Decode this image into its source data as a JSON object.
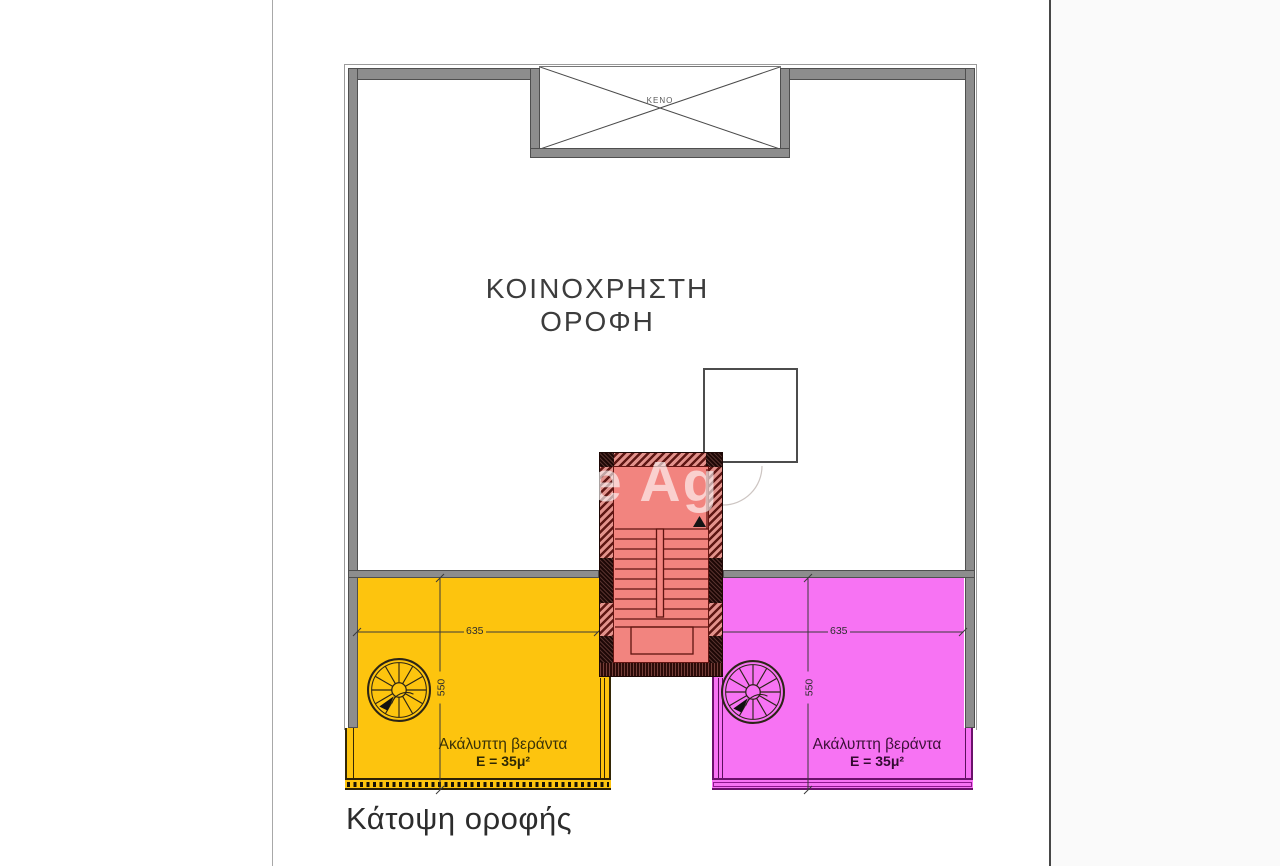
{
  "page": {
    "caption": "Κάτοψη οροφής",
    "watermark_text": "e Ag",
    "background": "#ffffff",
    "right_margin_color": "#fafafa"
  },
  "plan": {
    "roof_label_line1": "ΚΟΙΝΟΧΡΗΣΤΗ",
    "roof_label_line2": "ΟΡΟΦΗ",
    "void_label": "ΚΕΝΟ",
    "colors": {
      "wall_gray": "#8d8d8d",
      "stair_interior": "#f2847f",
      "stair_wall_hatch": "#5f1714",
      "veranda_left_fill": "#fdc40e",
      "veranda_right_fill": "#f773f3",
      "dimension_line": "#3a3a3a"
    },
    "verandas": {
      "left": {
        "label": "Ακάλυπτη βεράντα",
        "area": "E = 35μ²",
        "width_dim": "635",
        "depth_dim": "550"
      },
      "right": {
        "label": "Ακάλυπτη βεράντα",
        "area": "E = 35μ²",
        "width_dim": "635",
        "depth_dim": "550"
      }
    }
  }
}
